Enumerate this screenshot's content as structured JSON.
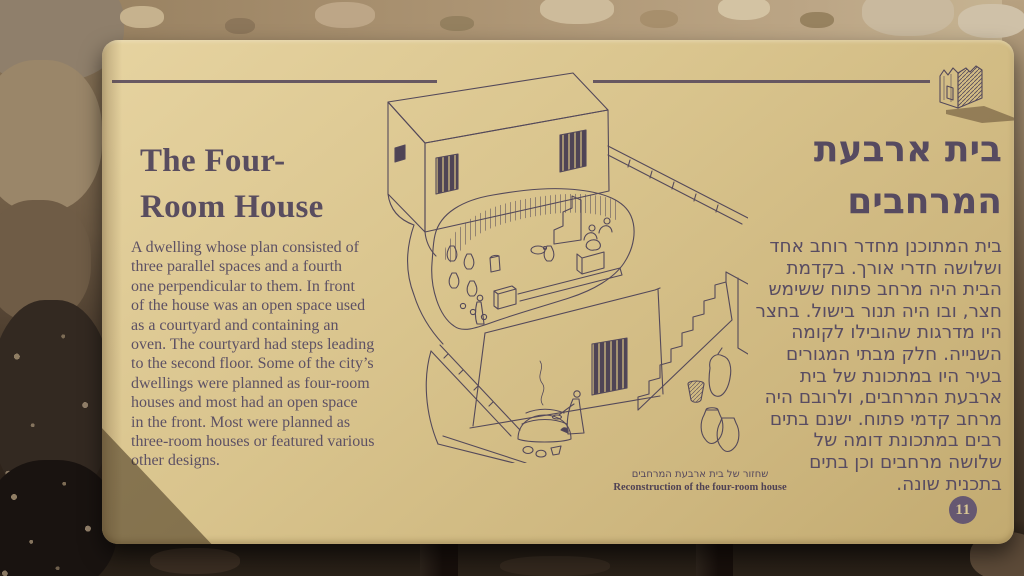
{
  "sign": {
    "title_en_lines": [
      "The Four-",
      "Room House"
    ],
    "body_en_lines": [
      "A dwelling whose plan consisted of",
      "three parallel spaces and a fourth",
      "one perpendicular to them. In front",
      "of the house was an open space used",
      "as a courtyard and containing an",
      "oven. The courtyard had steps leading",
      "to the second floor. Some of the city’s",
      "dwellings were planned as four-room",
      "houses and most had an open space",
      "in the front. Most were planned as",
      "three-room houses or featured various",
      "other designs."
    ],
    "title_he_lines": [
      "בית ארבעת",
      "המרחבים"
    ],
    "body_he_lines": [
      "בית המתוכנן מחדר רוחב אחד",
      "ושלושה חדרי אורך. בקדמת",
      "הבית היה מרחב פתוח ששימש",
      "חצר, ובו היה תנור בישול. בחצר",
      "היו מדרגות שהובילו לקומה",
      "השנייה. חלק מבתי המגורים",
      "בעיר היו במתכונת של בית",
      "ארבעת המרחבים, ולרובם היה",
      "מרחב קדמי פתוח. ישנם בתים",
      "רבים במתכונת דומה של",
      "שלושה מרחבים וכן בתים",
      "בתכנית שונה."
    ],
    "caption_he": "שחזור של בית ארבעת המרחבים",
    "caption_en": "Reconstruction of the four-room house",
    "badge_number": "11",
    "colors": {
      "panel": "#d9c48d",
      "ink": "#584c60",
      "badge": "#665871"
    },
    "icons": {
      "trail_marker": "house-model-icon"
    }
  }
}
